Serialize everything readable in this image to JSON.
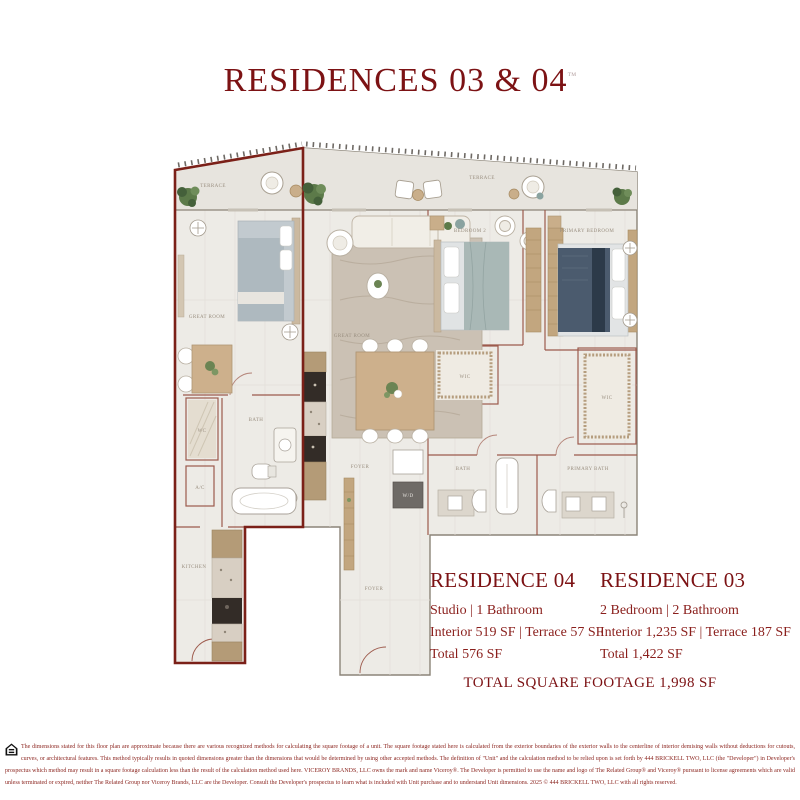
{
  "header": {
    "title": "RESIDENCES 03 & 04",
    "trademark": "™"
  },
  "residences": [
    {
      "name": "RESIDENCE 04",
      "type_line": "Studio | 1 Bathroom",
      "area_line": "Interior 519 SF | Terrace 57 SF",
      "total_line": "Total 576 SF"
    },
    {
      "name": "RESIDENCE 03",
      "type_line": "2 Bedroom | 2 Bathroom",
      "area_line": "Interior 1,235 SF | Terrace 187 SF",
      "total_line": "Total 1,422 SF"
    }
  ],
  "total_footage": "TOTAL SQUARE FOOTAGE 1,998 SF",
  "floorplan": {
    "labels": {
      "terrace_left": "TERRACE",
      "terrace_right": "TERRACE",
      "great_room_04": "GREAT ROOM",
      "great_room_03": "GREAT ROOM",
      "bedroom_2": "BEDROOM 2",
      "primary_bedroom": "PRIMARY BEDROOM",
      "wc": "WC",
      "bath_04": "BATH",
      "ac": "A/C",
      "kitchen_04": "KITCHEN",
      "foyer_1": "FOYER",
      "foyer_2": "FOYER",
      "wd": "W/D",
      "wic_1": "WIC",
      "wic_2": "WIC",
      "bath_03": "BATH",
      "primary_bath": "PRIMARY BATH"
    },
    "colors": {
      "accent_red": "#7c1214",
      "unit_outline": "#7b2018",
      "interior_wall": "#9d5a4c",
      "floor": "#edebe6",
      "terrace_floor": "#e7e4de",
      "wood": "#c9ae8a",
      "dark_cabinet": "#332c27",
      "plant_green": "#5c7a49"
    }
  },
  "footer": {
    "disclaimer": "The dimensions stated for this floor plan are approximate because there are various recognized methods for calculating the square footage of a unit. The square footage stated here is calculated from the exterior boundaries of the exterior walls to the centerline of interior demising walls without deductions for cutouts, curves, or architectural features. This method typically results in quoted dimensions greater than the dimensions that would be determined by using other accepted methods. The definition of \"Unit\" and the calculation method to be relied upon is set forth by 444 BRICKELL TWO, LLC (the \"Developer\") in Developer's prospectus which method may result in a square footage calculation less than the result of the calculation method used here. VICEROY BRANDS, LLC owns the mark and name Viceroy®. The Developer is permitted to use the name and logo of The Related Group® and Viceroy® pursuant to license agreements which are valid unless terminated or expired, neither The Related Group nor Viceroy Brands, LLC are the Developer. Consult the Developer's prospectus to learn what is included with Unit purchase and to understand Unit dimensions. 2025 © 444 BRICKELL TWO, LLC with all rights reserved."
  }
}
